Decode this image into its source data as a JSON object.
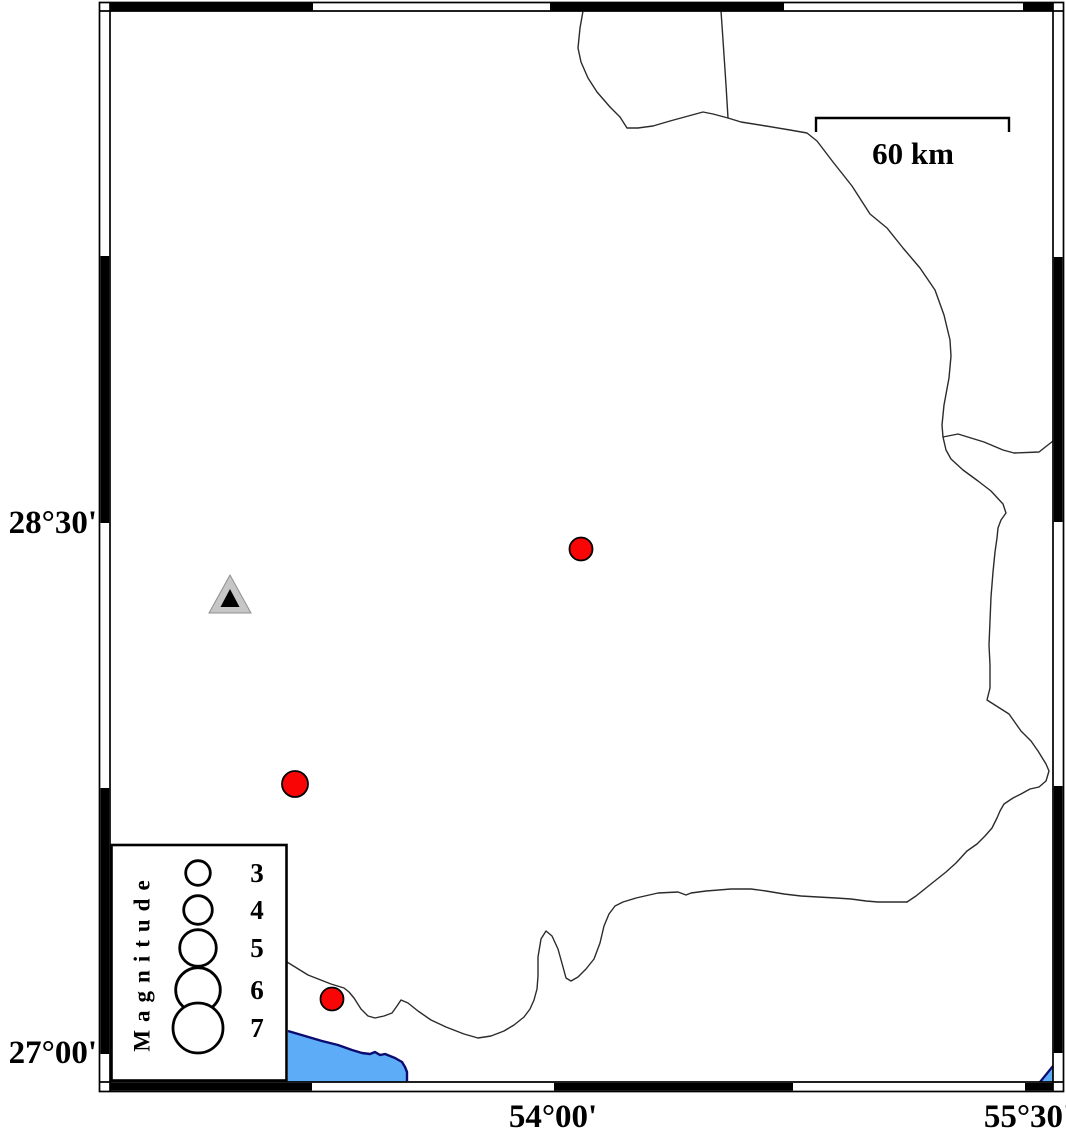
{
  "map": {
    "axis_labels": {
      "left": [
        {
          "text": "28°30'",
          "y": 523
        },
        {
          "text": "27°00'",
          "y": 1053
        }
      ],
      "bottom": [
        {
          "text": "54°00'",
          "x": 553
        },
        {
          "text": "55°30'",
          "x": 1028
        }
      ]
    },
    "scale_bar": {
      "label": "60 km"
    },
    "epicenters": [
      {
        "x": 581,
        "y": 549,
        "r": 11.5
      },
      {
        "x": 295,
        "y": 784,
        "r": 13
      },
      {
        "x": 332,
        "y": 999,
        "r": 11.5
      }
    ],
    "station": {
      "x": 230,
      "y": 597
    },
    "colors": {
      "epicenter_fill": "#fa0505",
      "epicenter_outline": "#000000",
      "water_fill": "#5cacf7",
      "water_outline": "#0b0b70",
      "station_fill": "#c6c6c6",
      "station_inner": "#000000",
      "boundary_line": "#2b2b2b",
      "frame": "#000000"
    }
  },
  "legend": {
    "title": "Magnitude",
    "items": [
      {
        "label": "3",
        "cy": 873,
        "r": 12.3
      },
      {
        "label": "4",
        "cy": 910,
        "r": 14.3
      },
      {
        "label": "5",
        "cy": 948,
        "r": 18.3
      },
      {
        "label": "6",
        "cy": 990,
        "r": 22.3
      },
      {
        "label": "7",
        "cy": 1028,
        "r": 25
      }
    ],
    "circle_cx": 198,
    "label_x": 257
  }
}
